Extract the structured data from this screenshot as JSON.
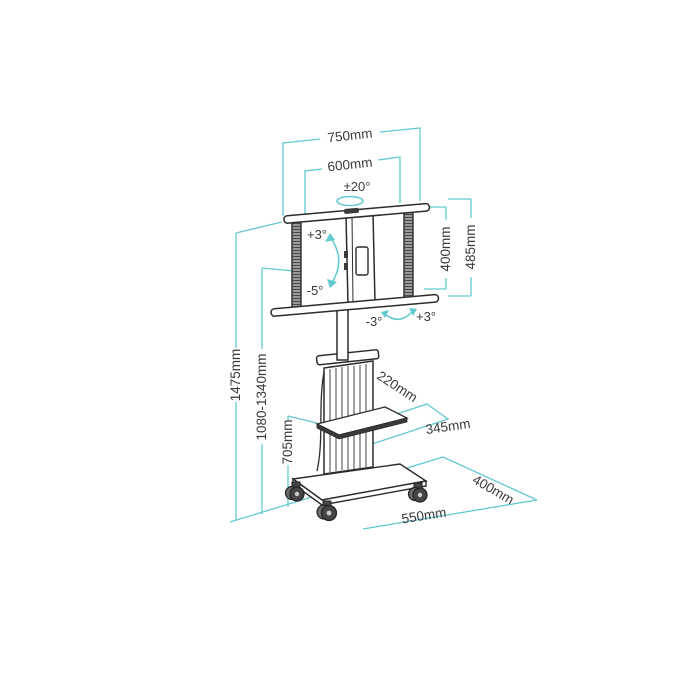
{
  "diagram": {
    "type": "technical-dimension-drawing",
    "subject": "mobile TV trolley stand with shelf and casters",
    "colors": {
      "dimension_line": "#63c9cf",
      "line_art": "#2c2c2c",
      "text": "#3a3a3a",
      "background": "#ffffff"
    },
    "labels": {
      "bracket_outer_width": "750mm",
      "bracket_inner_width": "600mm",
      "swivel_range": "±20°",
      "tilt_up": "+3°",
      "tilt_down": "-5°",
      "level_left": "-3°",
      "level_right": "+3°",
      "vesa_height": "400mm",
      "bracket_height": "485mm",
      "total_height": "1475mm",
      "screen_center_height": "1080-1340mm",
      "shelf_height": "705mm",
      "shelf_depth": "220mm",
      "shelf_width": "345mm",
      "base_depth": "400mm",
      "base_width": "550mm"
    }
  }
}
